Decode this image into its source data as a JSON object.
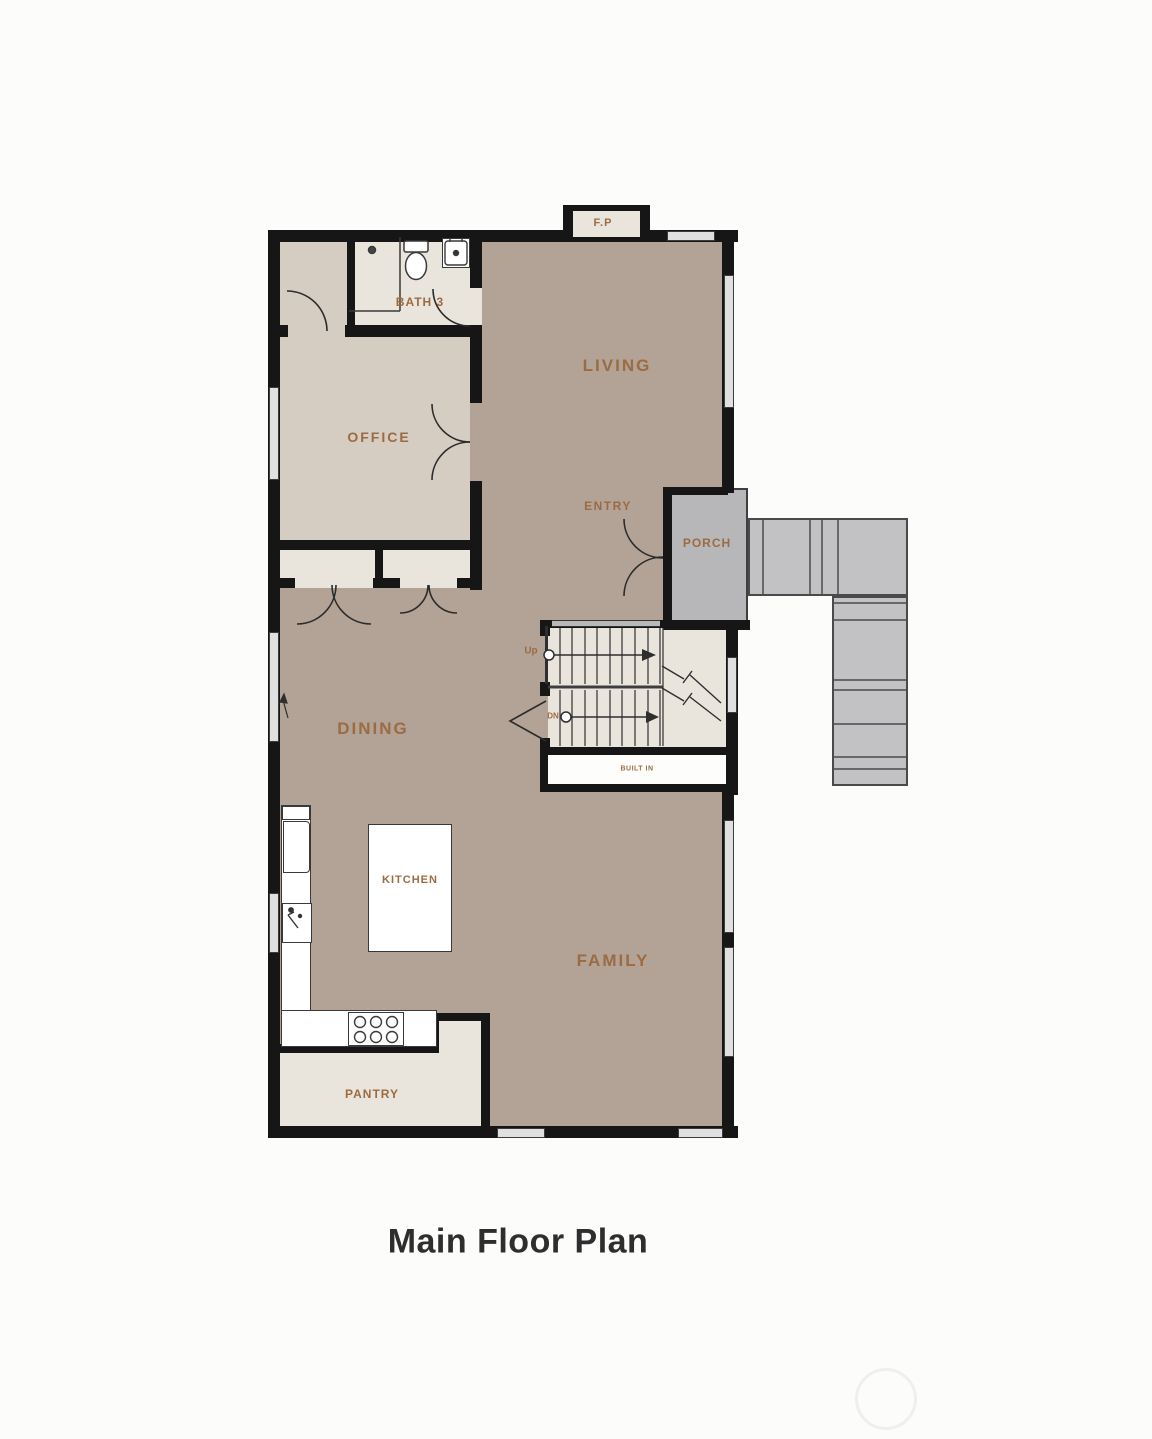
{
  "title": "Main Floor Plan",
  "labels": {
    "living": "LIVING",
    "office": "OFFICE",
    "bath": "BATH 3",
    "entry": "ENTRY",
    "porch": "PORCH",
    "dining": "DINING",
    "kitchen": "KITCHEN",
    "family": "FAMILY",
    "pantry": "PANTRY",
    "built_in": "BUILT IN",
    "fireplace": "F.P",
    "up": "Up",
    "down": "DN"
  },
  "colors": {
    "background": "#fcfcfb",
    "floor_main": "#b2a396",
    "floor_office": "#d5ccc2",
    "floor_light": "#eae5dc",
    "wall": "#161616",
    "porch": "#b7b6b8",
    "stairs_ext": "#c2c1c3",
    "window_fill": "#e0e0e0",
    "label": "#9c6b42",
    "title": "#2e2e2e"
  }
}
